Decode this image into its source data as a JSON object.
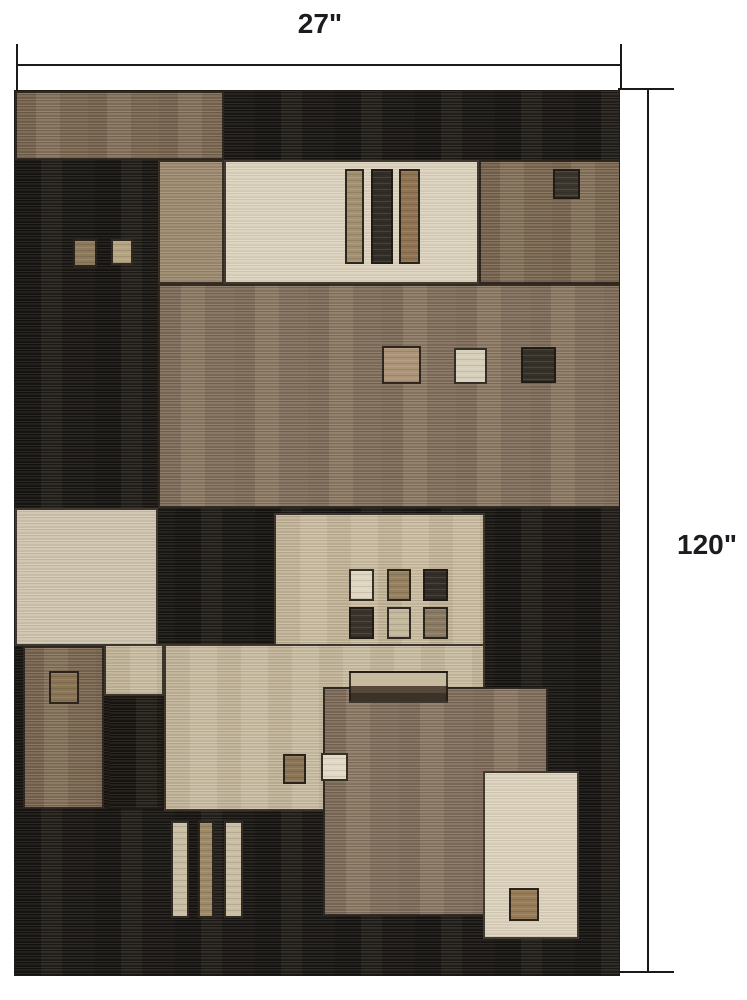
{
  "diagram": {
    "type": "product-dimension-diagram",
    "subject": "geometric patchwork area rug",
    "width": {
      "label": "27\""
    },
    "height": {
      "label": "120\""
    }
  },
  "palette": {
    "background": "#ffffff",
    "dimension_line": "#1a1a1a",
    "label_text": "#1b1b20",
    "rug_dark": "#292520",
    "rug_brown": "#7c6a55",
    "rug_tan": "#9c8a70",
    "rug_beige": "#c3b69c",
    "rug_light_beige": "#cdc1ad",
    "rug_cream": "#d9cfbb"
  }
}
